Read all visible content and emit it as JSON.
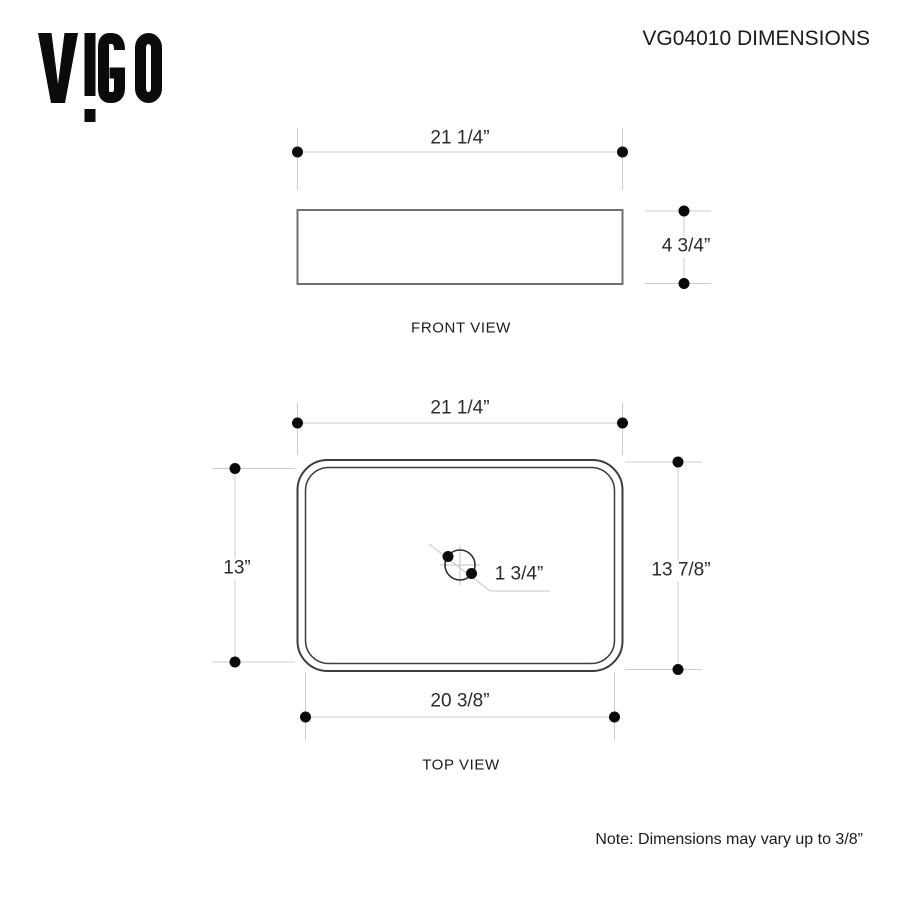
{
  "header": {
    "logo_brand": "VIGO",
    "title": "VG04010 DIMENSIONS"
  },
  "front_view": {
    "label": "FRONT VIEW",
    "width_dim": "21 1/4”",
    "height_dim": "4 3/4”"
  },
  "top_view": {
    "label": "TOP VIEW",
    "width_dim": "21 1/4”",
    "left_height_dim": "13”",
    "right_height_dim": "13 7/8”",
    "bottom_width_dim": "20 3/8”",
    "drain_dim": "1 3/4”"
  },
  "note": "Note: Dimensions may vary up to 3/8”",
  "colors": {
    "dimension_line": "#cccccc",
    "object_outline": "#3d3d3d",
    "front_outline": "#6f6f6f",
    "marker_dot": "#0a0a0a",
    "text": "#1e1e1e"
  }
}
